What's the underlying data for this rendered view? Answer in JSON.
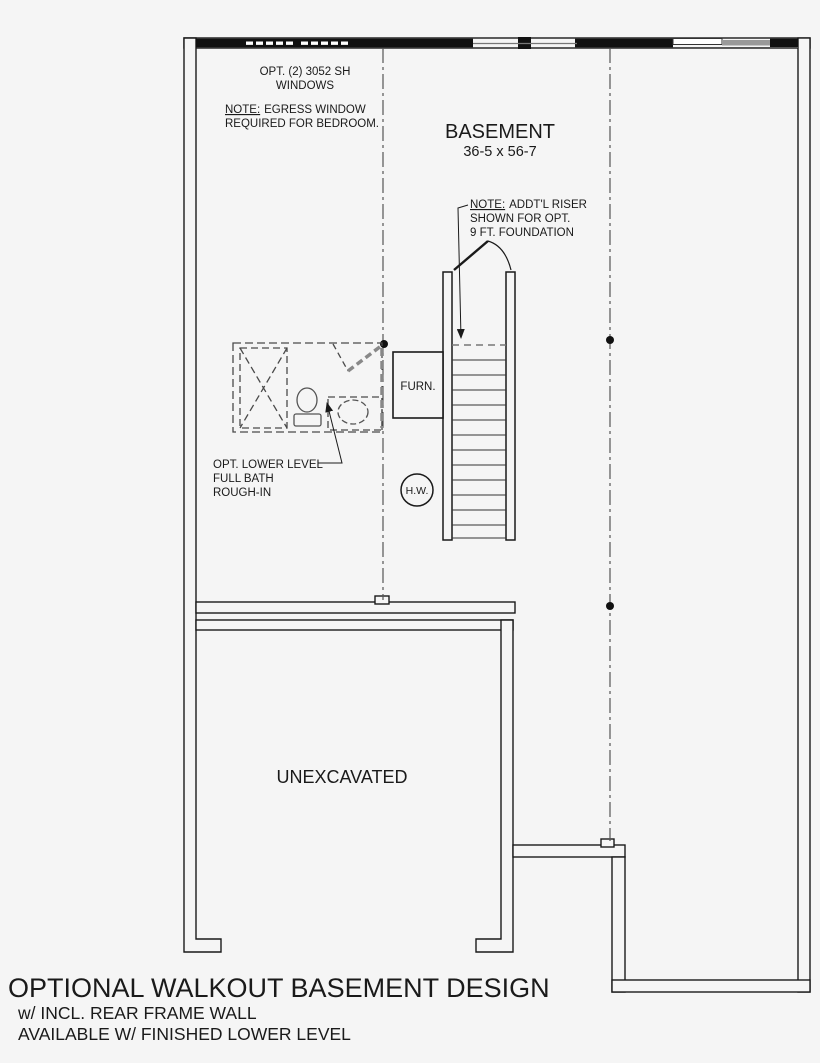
{
  "colors": {
    "line": "#1a1a1a",
    "background": "#f5f5f5",
    "dashed_gray": "#555555",
    "window_gray": "#9a9a9a"
  },
  "labels": {
    "basement_title": "BASEMENT",
    "basement_dims": "36-5 x 56-7",
    "unexcavated": "UNEXCAVATED",
    "furnace": "FURN.",
    "water_heater": "H.W."
  },
  "notes": {
    "opt_windows_line1": "OPT. (2) 3052 SH",
    "opt_windows_line2": "WINDOWS",
    "note_prefix": "NOTE:",
    "egress_line1": "EGRESS WINDOW",
    "egress_line2": "REQUIRED FOR BEDROOM.",
    "riser_line1": "ADDT'L RISER",
    "riser_line2": "SHOWN FOR OPT.",
    "riser_line3": "9 FT. FOUNDATION",
    "bath_line1": "OPT. LOWER LEVEL",
    "bath_line2": "FULL BATH",
    "bath_line3": "ROUGH-IN"
  },
  "title_block": {
    "title": "OPTIONAL WALKOUT BASEMENT DESIGN",
    "subtitle1": "w/ INCL. REAR FRAME WALL",
    "subtitle2": "AVAILABLE W/ FINISHED LOWER LEVEL"
  }
}
